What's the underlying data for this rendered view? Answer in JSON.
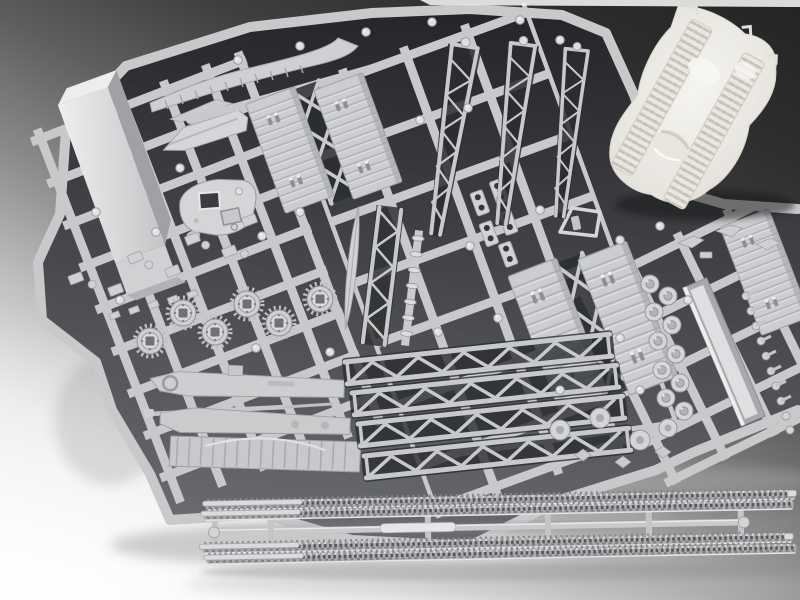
{
  "meta": {
    "kind": "photograph",
    "canvas": {
      "width": 800,
      "height": 600
    }
  },
  "scene": {
    "subject": "Unassembled plastic scale-model kit: light-gray injection-molded sprues with bridge and tank parts, a white textured terrain base section, and a separate sprue of four tank-track lengths",
    "setting": "Studio product shot on a smooth backdrop, lit from the lower left (dark gray upper right fading to white lower left)",
    "visible_text": "none"
  },
  "palette": {
    "backdrop_dark": "#242424",
    "backdrop_mid": "#8a8a8a",
    "backdrop_light": "#f8f8f8",
    "plastic_base": "#c7c9cb",
    "plastic_light": "#dcdee0",
    "plastic_bright": "#eceded",
    "plastic_shadow": "#9a9ca0",
    "gap_dark": "#232528",
    "gap_mid": "#606265",
    "terrain_white": "#f5f4f1",
    "terrain_shade": "#e2dfd8",
    "terrain_rut": "#c7c3b9",
    "track_base": "#aaacae",
    "track_dark": "#55575a",
    "track_light": "#e2e4e6"
  },
  "objects": [
    {
      "name": "sprue-cluster",
      "label": "Stacked gray part sprues (runner frames)"
    },
    {
      "name": "box-girder-part",
      "label": "Long rectangular box-girder / ramp section"
    },
    {
      "name": "pontoon-part",
      "label": "Small boat-shaped pontoon half"
    },
    {
      "name": "curved-beam-part",
      "label": "Long curved beam with segmented ribs"
    },
    {
      "name": "trackway-decks-a",
      "label": "Pair of ribbed trackway deck panels with X cross-braces"
    },
    {
      "name": "trackway-decks-b",
      "label": "Second pair of ribbed trackway deck panels"
    },
    {
      "name": "edge-deck-panel",
      "label": "Ribbed deck panel cut by right image edge"
    },
    {
      "name": "turret-part",
      "label": "Tank turret top with open and closed hatches"
    },
    {
      "name": "sprocket-wheels",
      "label": "Six toothed drive-sprocket wheels"
    },
    {
      "name": "small-fittings",
      "label": "Field of small fittings and brackets"
    },
    {
      "name": "hole-plates",
      "label": "Small plates with twin holes"
    },
    {
      "name": "frame-part",
      "label": "Trapezoid frame piece"
    },
    {
      "name": "hull-side-parts",
      "label": "Long hull side pieces, thin gun barrel and ribbed skirt"
    },
    {
      "name": "tapered-booms",
      "label": "Three tapered lattice truss booms"
    },
    {
      "name": "center-columns",
      "label": "Spindle, lattice column and ringed pole parts"
    },
    {
      "name": "warren-girders",
      "label": "Four parallel lattice (Warren) girders"
    },
    {
      "name": "roller-row",
      "label": "Zigzag row of small road-wheel rollers"
    },
    {
      "name": "channel-girder",
      "label": "U-channel girder part"
    },
    {
      "name": "pin-row",
      "label": "Column of small pins and bolts"
    },
    {
      "name": "bracket-bits",
      "label": "Tiny angled brackets"
    },
    {
      "name": "wheel-parts",
      "label": "Road wheels with hubs and winged fittings"
    },
    {
      "name": "terrain-base",
      "label": "White terrain base with twin tank-track ruts and a crater"
    },
    {
      "name": "track-sprue",
      "label": "Separate sprue: four tank-track lengths joined by a center runner"
    }
  ]
}
